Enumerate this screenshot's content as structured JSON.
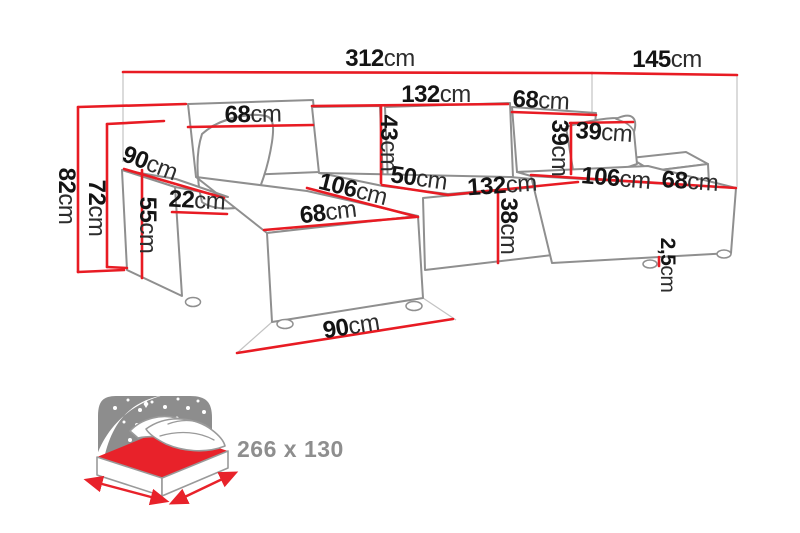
{
  "diagram": {
    "dimensions": {
      "total_width": {
        "value": "312",
        "unit": "cm"
      },
      "total_depth": {
        "value": "145",
        "unit": "cm"
      },
      "backrest_left_width": {
        "value": "68",
        "unit": "cm"
      },
      "backrest_mid_width": {
        "value": "132",
        "unit": "cm"
      },
      "backrest_right_width": {
        "value": "68",
        "unit": "cm"
      },
      "backrest_height": {
        "value": "43",
        "unit": "cm"
      },
      "pillow_right_height": {
        "value": "39",
        "unit": "cm"
      },
      "pillow_right_width": {
        "value": "39",
        "unit": "cm"
      },
      "total_height": {
        "value": "82",
        "unit": "cm"
      },
      "frame_height": {
        "value": "72",
        "unit": "cm"
      },
      "armrest_depth": {
        "value": "90",
        "unit": "cm"
      },
      "armrest_width": {
        "value": "22",
        "unit": "cm"
      },
      "armrest_height": {
        "value": "55",
        "unit": "cm"
      },
      "chaise_left_depth": {
        "value": "106",
        "unit": "cm"
      },
      "chaise_left_width": {
        "value": "68",
        "unit": "cm"
      },
      "seat_depth": {
        "value": "50",
        "unit": "cm"
      },
      "seat_width": {
        "value": "132",
        "unit": "cm"
      },
      "seat_height": {
        "value": "38",
        "unit": "cm"
      },
      "chaise_right_depth": {
        "value": "106",
        "unit": "cm"
      },
      "chaise_right_width": {
        "value": "68",
        "unit": "cm"
      },
      "floor_depth": {
        "value": "90",
        "unit": "cm"
      },
      "leg_height": {
        "value": "2,5",
        "unit": "cm"
      }
    },
    "sleeping_area": {
      "label": "266 x 130"
    },
    "colors": {
      "dimension_line": "#e81b23",
      "sofa_outline": "#8f8f8f",
      "label_number": "#141414",
      "label_unit": "#2d2d2d",
      "icon_sky_gray": "#8d8d8d",
      "icon_mattress_red": "#e8222a",
      "sleeping_label_gray": "#8e8e8e"
    }
  }
}
